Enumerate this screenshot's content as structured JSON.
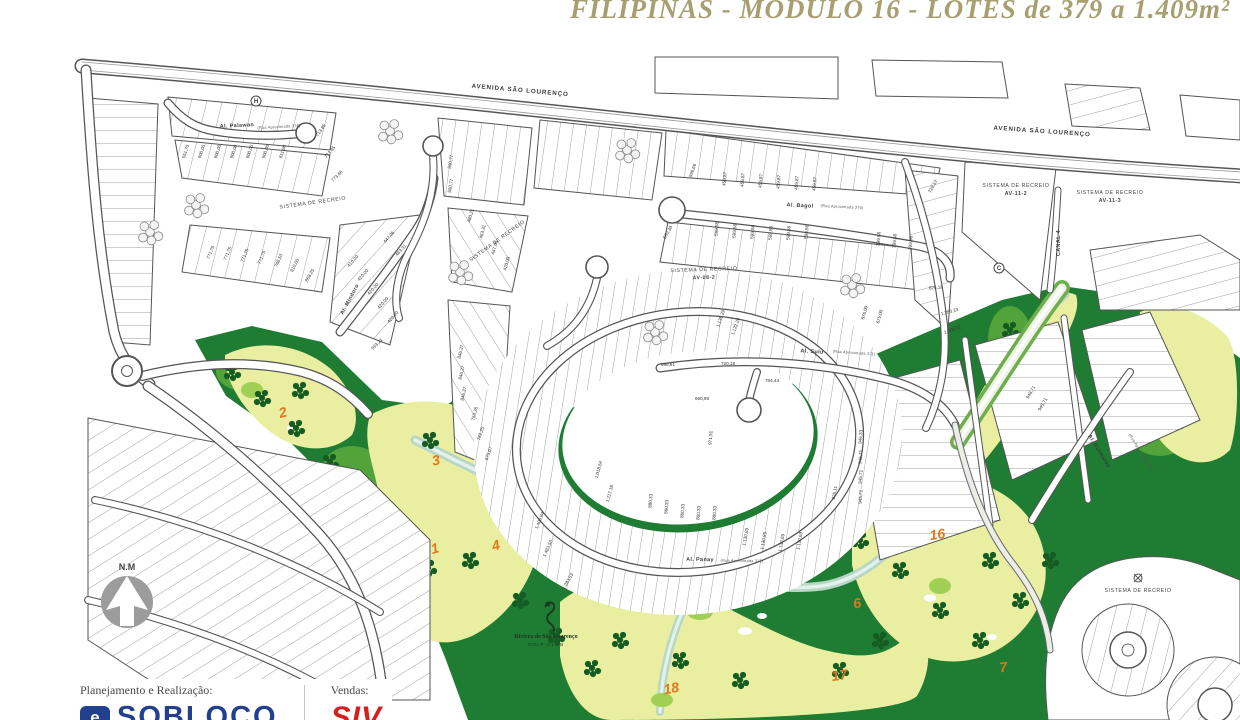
{
  "title": {
    "text": "FILIPINAS - MODULO 16 - LOTES de 379 a 1.409m²",
    "color": "#a89f70"
  },
  "compass": {
    "label": "N.M"
  },
  "golf_club": {
    "name": "Riviera de São Lourenço",
    "subtitle": "GOLF CLUB"
  },
  "footer": {
    "planning_label": "Planejamento e Realização:",
    "planning_brand": "SOBLOCO",
    "planning_mark": "e",
    "sales_label": "Vendas:",
    "sales_brand": "SIV",
    "brand_blue": "#23408f",
    "brand_red": "#d6201f"
  },
  "map": {
    "colors": {
      "line": "#4a4a4a",
      "golf_dark_green": "#1f7c33",
      "golf_mid_green": "#53a33b",
      "fairway_yellow": "#e9eea1",
      "tree_green": "#155c23",
      "creek": "#b7d6c4",
      "hole_orange": "#e2761c",
      "compass_gray": "#9c9c9c"
    },
    "avenue_labels": [
      {
        "t": "AVENIDA SÃO LOURENÇO",
        "x": 520,
        "y": 92,
        "r": 5
      },
      {
        "t": "AVENIDA SÃO LOURENÇO",
        "x": 1042,
        "y": 133,
        "r": 4
      }
    ],
    "street_labels": [
      {
        "t": "Al. Palawan",
        "sub": "(Rua Aproximada 378)",
        "x": 237,
        "y": 127,
        "r": -3
      },
      {
        "t": "Al. Bagol",
        "sub": "(Rua Aproximada 370)",
        "x": 800,
        "y": 207,
        "r": 3
      },
      {
        "t": "Al. Mindoro",
        "sub": "",
        "x": 351,
        "y": 300,
        "r": -62
      },
      {
        "t": "Al. Sulu",
        "sub": "(Rua Aproximada 371)",
        "x": 812,
        "y": 353,
        "r": 4
      },
      {
        "t": "Al. Panay",
        "sub": "(Rua Aproximada 372)",
        "x": 700,
        "y": 561,
        "r": 1
      },
      {
        "t": "Al. Guimaras",
        "sub": "(Rua Aproximada 362)",
        "x": 1098,
        "y": 452,
        "r": 58
      },
      {
        "t": "CANAL 4",
        "sub": "",
        "x": 1060,
        "y": 243,
        "r": -90
      }
    ],
    "zone_labels": [
      {
        "t": "SISTEMA DE RECREIO",
        "sub": "",
        "x": 313,
        "y": 204,
        "r": -8
      },
      {
        "t": "SISTEMA DE RECREIO",
        "sub": "",
        "x": 498,
        "y": 242,
        "r": -36
      },
      {
        "t": "SISTEMA DE RECREIO",
        "sub": "AV-08-2",
        "x": 704,
        "y": 271,
        "r": -2
      },
      {
        "t": "SISTEMA DE RECREIO",
        "sub": "AV-11-2",
        "x": 1016,
        "y": 187,
        "r": 0
      },
      {
        "t": "SISTEMA DE RECREIO",
        "sub": "AV-11-3",
        "x": 1110,
        "y": 194,
        "r": 0
      },
      {
        "t": "SISTEMA DE RECREIO",
        "sub": "",
        "x": 1138,
        "y": 592,
        "r": 0
      }
    ],
    "block_markers": [
      {
        "t": "H",
        "x": 256,
        "y": 101
      },
      {
        "t": "C",
        "x": 999,
        "y": 268
      }
    ],
    "hole_numbers": [
      {
        "n": "2",
        "x": 284,
        "y": 417,
        "r": -15
      },
      {
        "n": "3",
        "x": 437,
        "y": 465,
        "r": -12
      },
      {
        "n": "1",
        "x": 436,
        "y": 553,
        "r": -15
      },
      {
        "n": "4",
        "x": 497,
        "y": 550,
        "r": -15
      },
      {
        "n": "18",
        "x": 672,
        "y": 693,
        "r": -10
      },
      {
        "n": "17",
        "x": 840,
        "y": 680,
        "r": -8
      },
      {
        "n": "6",
        "x": 858,
        "y": 608,
        "r": -10
      },
      {
        "n": "16",
        "x": 938,
        "y": 539,
        "r": -8
      },
      {
        "n": "7",
        "x": 1004,
        "y": 672,
        "r": -8
      }
    ],
    "lot_labels": [
      {
        "v": "551,70",
        "x": 187,
        "y": 152,
        "r": -72
      },
      {
        "v": "600,00",
        "x": 203,
        "y": 152,
        "r": -72
      },
      {
        "v": "600,00",
        "x": 219,
        "y": 152,
        "r": -72
      },
      {
        "v": "600,00",
        "x": 235,
        "y": 152,
        "r": -72
      },
      {
        "v": "600,00",
        "x": 251,
        "y": 152,
        "r": -72
      },
      {
        "v": "600,00",
        "x": 267,
        "y": 152,
        "r": -72
      },
      {
        "v": "611,90",
        "x": 284,
        "y": 152,
        "r": -72
      },
      {
        "v": "713,85",
        "x": 322,
        "y": 131,
        "r": -55
      },
      {
        "v": "713,85",
        "x": 331,
        "y": 153,
        "r": -50
      },
      {
        "v": "773,86",
        "x": 338,
        "y": 177,
        "r": -45
      },
      {
        "v": "771,75",
        "x": 212,
        "y": 253,
        "r": -68
      },
      {
        "v": "771,75",
        "x": 229,
        "y": 254,
        "r": -68
      },
      {
        "v": "771,75",
        "x": 246,
        "y": 256,
        "r": -68
      },
      {
        "v": "771,75",
        "x": 263,
        "y": 258,
        "r": -68
      },
      {
        "v": "768,53",
        "x": 280,
        "y": 261,
        "r": -68
      },
      {
        "v": "810,00",
        "x": 296,
        "y": 266,
        "r": -64
      },
      {
        "v": "868,25",
        "x": 311,
        "y": 276,
        "r": -60
      },
      {
        "v": "410,00",
        "x": 354,
        "y": 262,
        "r": -48
      },
      {
        "v": "420,00",
        "x": 364,
        "y": 276,
        "r": -48
      },
      {
        "v": "420,00",
        "x": 374,
        "y": 290,
        "r": -48
      },
      {
        "v": "420,00",
        "x": 384,
        "y": 304,
        "r": -48
      },
      {
        "v": "420,00",
        "x": 394,
        "y": 318,
        "r": -48
      },
      {
        "v": "447,06",
        "x": 390,
        "y": 238,
        "r": -48
      },
      {
        "v": "463,31",
        "x": 402,
        "y": 251,
        "r": -48
      },
      {
        "v": "563,21",
        "x": 378,
        "y": 345,
        "r": -45
      },
      {
        "v": "480,21",
        "x": 472,
        "y": 216,
        "r": -75
      },
      {
        "v": "463,31",
        "x": 484,
        "y": 232,
        "r": -75
      },
      {
        "v": "447,06",
        "x": 496,
        "y": 248,
        "r": -75
      },
      {
        "v": "420,00",
        "x": 508,
        "y": 264,
        "r": -75
      },
      {
        "v": "560,77",
        "x": 452,
        "y": 186,
        "r": -80
      },
      {
        "v": "590,77",
        "x": 452,
        "y": 162,
        "r": -80
      },
      {
        "v": "846,37",
        "x": 462,
        "y": 352,
        "r": -78
      },
      {
        "v": "846,37",
        "x": 463,
        "y": 373,
        "r": -78
      },
      {
        "v": "846,37",
        "x": 465,
        "y": 394,
        "r": -78
      },
      {
        "v": "753,26",
        "x": 476,
        "y": 414,
        "r": -75
      },
      {
        "v": "762,25",
        "x": 482,
        "y": 434,
        "r": -72
      },
      {
        "v": "875,07",
        "x": 490,
        "y": 454,
        "r": -70
      },
      {
        "v": "596,66",
        "x": 694,
        "y": 171,
        "r": -70
      },
      {
        "v": "560,38",
        "x": 669,
        "y": 233,
        "r": -60
      },
      {
        "v": "459,87",
        "x": 726,
        "y": 179,
        "r": -85
      },
      {
        "v": "459,87",
        "x": 744,
        "y": 180,
        "r": -85
      },
      {
        "v": "459,87",
        "x": 762,
        "y": 181,
        "r": -85
      },
      {
        "v": "459,87",
        "x": 780,
        "y": 182,
        "r": -85
      },
      {
        "v": "459,87",
        "x": 798,
        "y": 183,
        "r": -85
      },
      {
        "v": "459,87",
        "x": 816,
        "y": 184,
        "r": -85
      },
      {
        "v": "599,56",
        "x": 718,
        "y": 229,
        "r": -85
      },
      {
        "v": "599,56",
        "x": 736,
        "y": 231,
        "r": -85
      },
      {
        "v": "599,56",
        "x": 754,
        "y": 232,
        "r": -85
      },
      {
        "v": "599,56",
        "x": 772,
        "y": 233,
        "r": -85
      },
      {
        "v": "599,56",
        "x": 790,
        "y": 233,
        "r": -85
      },
      {
        "v": "599,56",
        "x": 808,
        "y": 232,
        "r": -85
      },
      {
        "v": "399,58",
        "x": 880,
        "y": 239,
        "r": -85
      },
      {
        "v": "399,58",
        "x": 896,
        "y": 241,
        "r": -85
      },
      {
        "v": "399,58",
        "x": 912,
        "y": 243,
        "r": -85
      },
      {
        "v": "729,12",
        "x": 934,
        "y": 187,
        "r": -62
      },
      {
        "v": "625,18",
        "x": 936,
        "y": 289,
        "r": -5
      },
      {
        "v": "1.200,13",
        "x": 950,
        "y": 313,
        "r": -15
      },
      {
        "v": "1.208,41",
        "x": 953,
        "y": 331,
        "r": -20
      },
      {
        "v": "1.135,29",
        "x": 722,
        "y": 319,
        "r": -70
      },
      {
        "v": "1.122,29",
        "x": 737,
        "y": 327,
        "r": -70
      },
      {
        "v": "676,00",
        "x": 866,
        "y": 313,
        "r": -75
      },
      {
        "v": "675,00",
        "x": 881,
        "y": 317,
        "r": -75
      },
      {
        "v": "720,18",
        "x": 728,
        "y": 365,
        "r": 0
      },
      {
        "v": "764,44",
        "x": 772,
        "y": 382,
        "r": 0
      },
      {
        "v": "698,61",
        "x": 668,
        "y": 366,
        "r": 0
      },
      {
        "v": "690,99",
        "x": 702,
        "y": 400,
        "r": 0
      },
      {
        "v": "971,91",
        "x": 712,
        "y": 438,
        "r": -85
      },
      {
        "v": "1.018,54",
        "x": 600,
        "y": 470,
        "r": -75
      },
      {
        "v": "1.117,18",
        "x": 611,
        "y": 494,
        "r": -75
      },
      {
        "v": "1.409,84",
        "x": 541,
        "y": 521,
        "r": -68
      },
      {
        "v": "1.483,56",
        "x": 549,
        "y": 549,
        "r": -66
      },
      {
        "v": "1.283,53",
        "x": 569,
        "y": 582,
        "r": -60
      },
      {
        "v": "880,33",
        "x": 652,
        "y": 501,
        "r": -85
      },
      {
        "v": "860,33",
        "x": 668,
        "y": 507,
        "r": -85
      },
      {
        "v": "860,33",
        "x": 684,
        "y": 511,
        "r": -85
      },
      {
        "v": "860,33",
        "x": 700,
        "y": 513,
        "r": -85
      },
      {
        "v": "860,33",
        "x": 716,
        "y": 513,
        "r": -85
      },
      {
        "v": "925,11",
        "x": 836,
        "y": 493,
        "r": -80
      },
      {
        "v": "1.130,89",
        "x": 747,
        "y": 537,
        "r": -80
      },
      {
        "v": "1.130,89",
        "x": 765,
        "y": 541,
        "r": -80
      },
      {
        "v": "1.130,89",
        "x": 783,
        "y": 543,
        "r": -80
      },
      {
        "v": "1.130,69",
        "x": 801,
        "y": 541,
        "r": -80
      },
      {
        "v": "946,33",
        "x": 862,
        "y": 437,
        "r": -85
      },
      {
        "v": "945,71",
        "x": 862,
        "y": 457,
        "r": -85
      },
      {
        "v": "945,71",
        "x": 862,
        "y": 477,
        "r": -85
      },
      {
        "v": "945,71",
        "x": 862,
        "y": 497,
        "r": -85
      },
      {
        "v": "948,71",
        "x": 1032,
        "y": 393,
        "r": -60
      },
      {
        "v": "945,71",
        "x": 1044,
        "y": 405,
        "r": -60
      }
    ]
  }
}
